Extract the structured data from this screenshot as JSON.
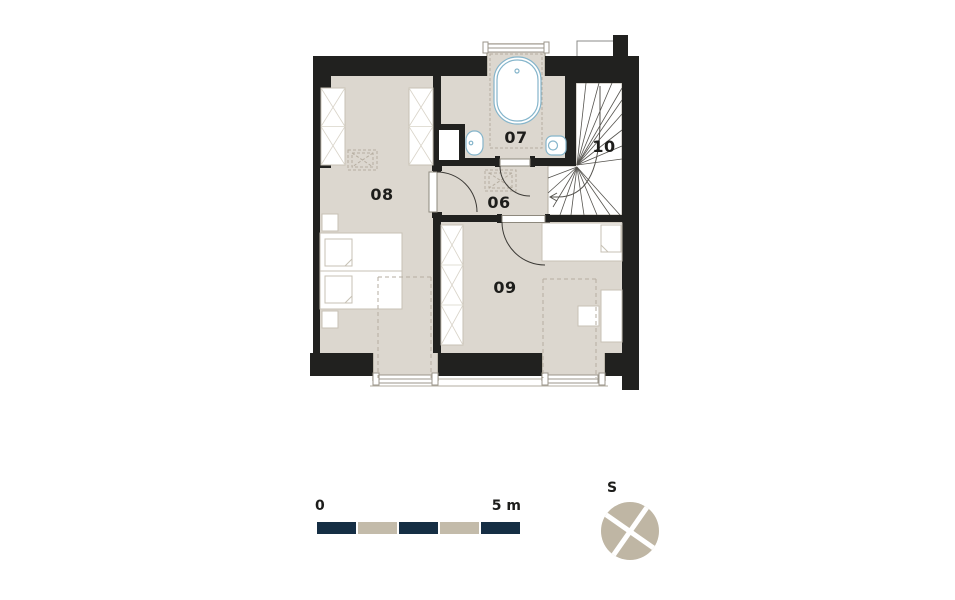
{
  "plan": {
    "title": "Floor plan - attic storey",
    "rooms": {
      "hall": {
        "number": "06"
      },
      "bathroom": {
        "number": "07"
      },
      "bedroom_left": {
        "number": "08"
      },
      "bedroom_right": {
        "number": "09"
      },
      "staircase": {
        "number": "10"
      }
    }
  },
  "scale_bar": {
    "start_label": "0",
    "end_label": "5 m",
    "segments": 5,
    "color_dark": "#152e44",
    "color_light": "#c3bbaa"
  },
  "compass": {
    "label": "S",
    "color": "#bfb6a4"
  },
  "colors": {
    "wall": "#21211f",
    "floor": "#dcd7cf",
    "fixture_outline": "#85b5cb",
    "furniture_outline": "#c7c1b5",
    "dashed_line": "#b6aea1",
    "text": "#1d1d1b"
  }
}
